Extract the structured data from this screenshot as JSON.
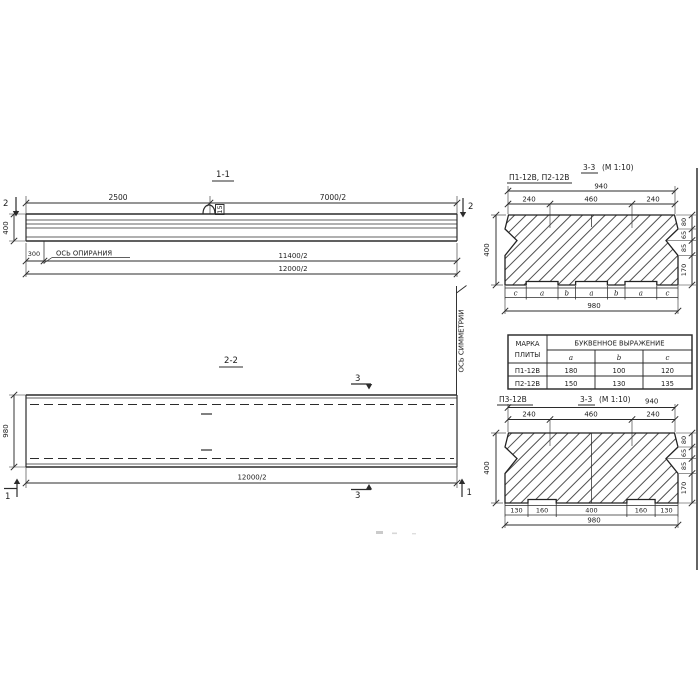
{
  "s11": {
    "title": "1-1",
    "dim_2500": "2500",
    "dim_7000_2": "7000/2",
    "cut2": "2",
    "dim_400": "400",
    "dim_300": "300",
    "support_axis": "ОСЬ ОПИРАНИЯ",
    "dim_11400_2": "11400/2",
    "dim_12000_2": "12000/2",
    "loop_tag": "15"
  },
  "s22": {
    "title": "2-2",
    "cut3": "3",
    "cut1": "1",
    "dim_980": "980",
    "dim_12000_2": "12000/2",
    "symmetry_axis": "ОСЬ СИММЕТРИИ"
  },
  "cs_top": {
    "marks": "П1-12В, П2-12В",
    "section": "3-3",
    "scale": "(М 1:10)",
    "dim_940": "940",
    "dim_240": "240",
    "dim_460": "460",
    "dim_400": "400",
    "right_dims": [
      "80",
      "65",
      "85",
      "170"
    ],
    "letters": [
      "c",
      "a",
      "b",
      "a",
      "b",
      "a",
      "c"
    ],
    "dim_980": "980"
  },
  "table": {
    "header_col1_line1": "МАРКА",
    "header_col1_line2": "ПЛИТЫ",
    "header_group": "БУКВЕННОЕ  ВЫРАЖЕНИЕ",
    "cols": [
      "a",
      "b",
      "c"
    ],
    "rows": [
      {
        "mark": "П1-12В",
        "a": "180",
        "b": "100",
        "c": "120"
      },
      {
        "mark": "П2-12В",
        "a": "150",
        "b": "130",
        "c": "135"
      }
    ]
  },
  "cs_bot": {
    "mark": "П3-12В",
    "section": "3-3",
    "scale": "(М 1:10)",
    "dim_940": "940",
    "dim_240": "240",
    "dim_460": "460",
    "dim_400": "400",
    "right_dims": [
      "80",
      "65",
      "85",
      "170"
    ],
    "bottom_dims": [
      "130",
      "160",
      "400",
      "160",
      "130"
    ],
    "dim_980": "980"
  }
}
